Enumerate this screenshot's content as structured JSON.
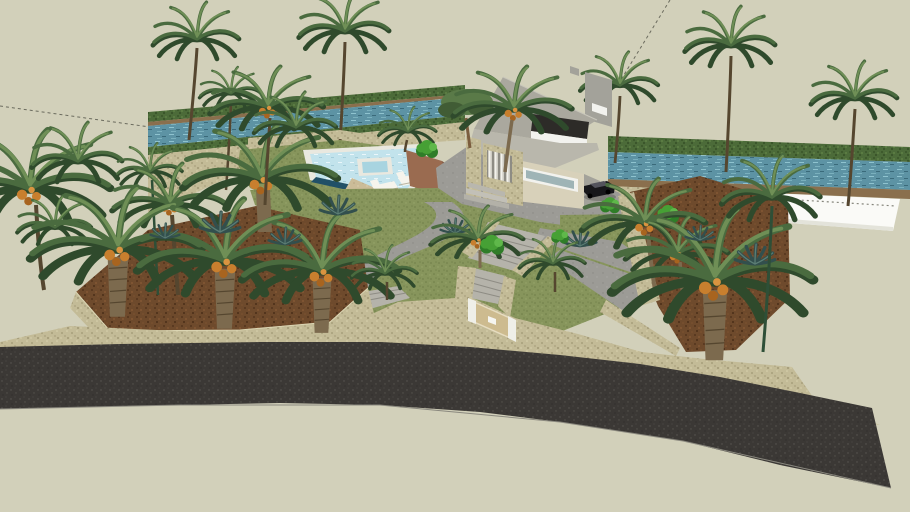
{
  "viewport": {
    "type": "3d-model-render",
    "description": "Aerial 3D rendering of a modern seaside villa with terraced palm garden, swimming pool, entrance gate and asphalt road along two water canals"
  },
  "scene": {
    "objects": [
      "villa",
      "swimming-pool",
      "jacuzzi",
      "sun-loungers",
      "pool-deck",
      "terracotta-wall",
      "driveway",
      "car",
      "pine-tree",
      "palm-trees",
      "date-palms",
      "stubby-palms",
      "agave-plants",
      "bushes",
      "central-lawn",
      "garden-paths",
      "staircase",
      "garden-ramp",
      "entrance-gate",
      "gate-posts",
      "planter-bed-left",
      "planter-bed-right",
      "boundary-wall",
      "asphalt-road",
      "canal-left",
      "canal-right",
      "canal-banks",
      "white-seawall",
      "construction-guide-lines"
    ],
    "counts": {
      "sun_loungers": 2,
      "cars": 1,
      "canals": 2,
      "gates": 1
    }
  },
  "colors": {
    "background": "#d2d0ba",
    "guide_line": "#6b6b5e",
    "stone_wall": "#c3bb97",
    "stone_cap": "#dcd6b4",
    "dirt": "#6e4a2c",
    "lawn": "#87955c",
    "path": "#9c9b96",
    "ramp": "#b5b3aa",
    "road": "#3b3835",
    "road_edge": "#8a887e",
    "canal_water": "#5d93a4",
    "canal_bank": "#4c6b39",
    "canal_shore": "#8a6f4d",
    "white_wall": "#fafaf7",
    "white_wall_shade": "#e3e3da",
    "pool_water": "#c2e3ec",
    "pool_dark_edge": "#215067",
    "pool_coping": "#e9e8df",
    "deck": "#cbbc98",
    "terracotta_top": "#9a6b50",
    "terracotta_side": "#7c4f39",
    "lounger": "#f6f4ec",
    "house_roof": "#aaa89e",
    "house_roof_light": "#b9b7ac",
    "house_wall": "#d8d1ba",
    "house_wall_gray": "#a3a29a",
    "roof_deck_dark": "#2d2b28",
    "window_white": "#f2f2ee",
    "window_glass": "#9fb4b6",
    "slat_dark": "#8e8c84",
    "car_body": "#17171a",
    "car_glass": "#53535c",
    "gate_panel": "#cdbb8f",
    "gate_post": "#efefe8",
    "palm_dark": "#2f4a2c",
    "palm_mid": "#4a6b3f",
    "palm_light": "#6f8f56",
    "trunk_brown": "#7c6a4e",
    "trunk_dark": "#55462f",
    "trunk_green": "#2e4f37",
    "fruit_orange": "#c87f2e",
    "agave": "#324f4d",
    "agave_light": "#5b7d74",
    "bush_green": "#46a035",
    "bush_dark": "#2f7d28",
    "pine_green": "#5a7a48",
    "pine_dark": "#415c35"
  }
}
